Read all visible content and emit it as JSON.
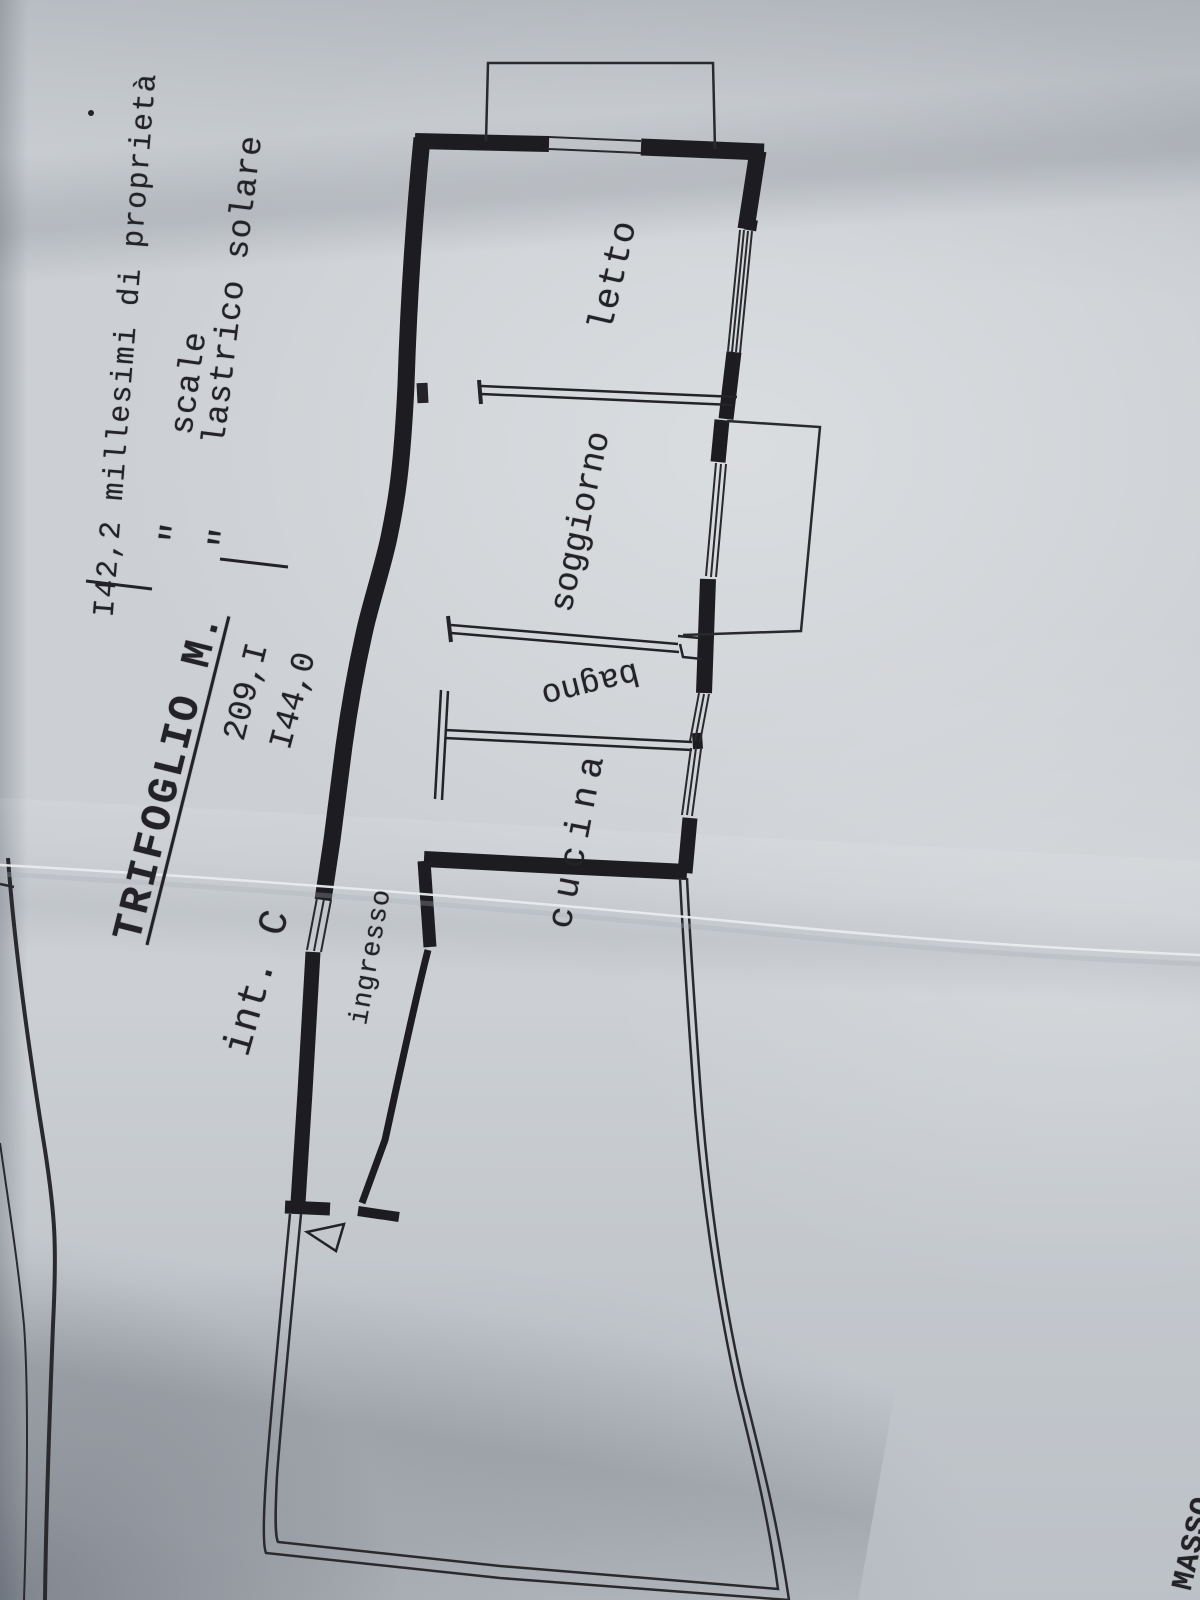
{
  "sheet": {
    "header": {
      "title": "TRIFOGLIO M.",
      "interno": "int. C",
      "ownership_line": "I42,2 millesimi di proprietà",
      "rows": [
        {
          "value": "209,I",
          "ditto": "\"",
          "label": "scale"
        },
        {
          "value": "I44,0",
          "ditto": "\"",
          "label": "lastrico solare"
        }
      ]
    },
    "room_labels": {
      "bedroom": "letto",
      "living_room": "soggiorno",
      "bathroom": "bagno",
      "kitchen": "cucina",
      "entrance": "ingresso"
    },
    "corner_stamp": "L MASSO",
    "icons": {
      "entrance_arrow": "triangle-outline"
    },
    "colors": {
      "ink": "#232327",
      "paper": "#ccd0d4",
      "crease_highlight": "#e9ebed"
    }
  }
}
